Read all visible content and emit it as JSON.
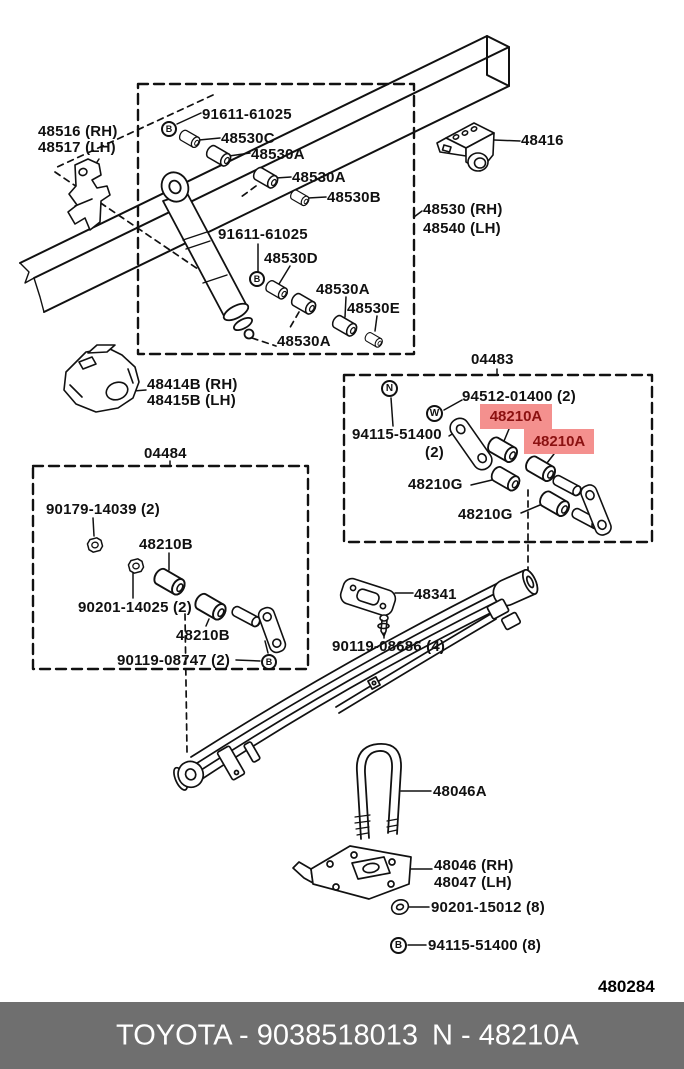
{
  "page": {
    "code": "480284"
  },
  "footer": {
    "left_text": "TOYOTA - 9038518013",
    "right_text": "N - 48210A",
    "bg_color": "#6F6F6F",
    "text_color": "#FFFFFF"
  },
  "highlight": {
    "part": "48210A",
    "bg_color": "#F4908E",
    "text_color": "#8B1111"
  },
  "symbols": {
    "bolt": "B",
    "nut": "N",
    "washer": "W"
  },
  "sections": {
    "box1_code": "04483",
    "box2_code": "04484"
  },
  "labels": {
    "l48516": "48516 (RH)",
    "l48517": "48517 (LH)",
    "l91611_1": "91611-61025",
    "l48530c": "48530C",
    "l48530a_1": "48530A",
    "l48530a_2": "48530A",
    "l48530b": "48530B",
    "l91611_2": "91611-61025",
    "l48530d": "48530D",
    "l48530a_3": "48530A",
    "l48530e": "48530E",
    "l48530a_4": "48530A",
    "l48416": "48416",
    "l48530_rh": "48530 (RH)",
    "l48540_lh": "48540 (LH)",
    "l48414b": "48414B (RH)",
    "l48415b": "48415B (LH)",
    "l94512": "94512-01400 (2)",
    "l94115_2": "94115-51400",
    "l94115_2_qty": "(2)",
    "l48210a_1": "48210A",
    "l48210a_2": "48210A",
    "l48210g_1": "48210G",
    "l48210g_2": "48210G",
    "l90179": "90179-14039 (2)",
    "l48210b_1": "48210B",
    "l90201_14025": "90201-14025 (2)",
    "l48210b_2": "48210B",
    "l90119_08747": "90119-08747 (2)",
    "l48341": "48341",
    "l90119_08686": "90119-08686 (4)",
    "l48046a": "48046A",
    "l48046_rh": "48046 (RH)",
    "l48047_lh": "48047 (LH)",
    "l90201_15012": "90201-15012 (8)",
    "l94115_8": "94115-51400 (8)"
  }
}
